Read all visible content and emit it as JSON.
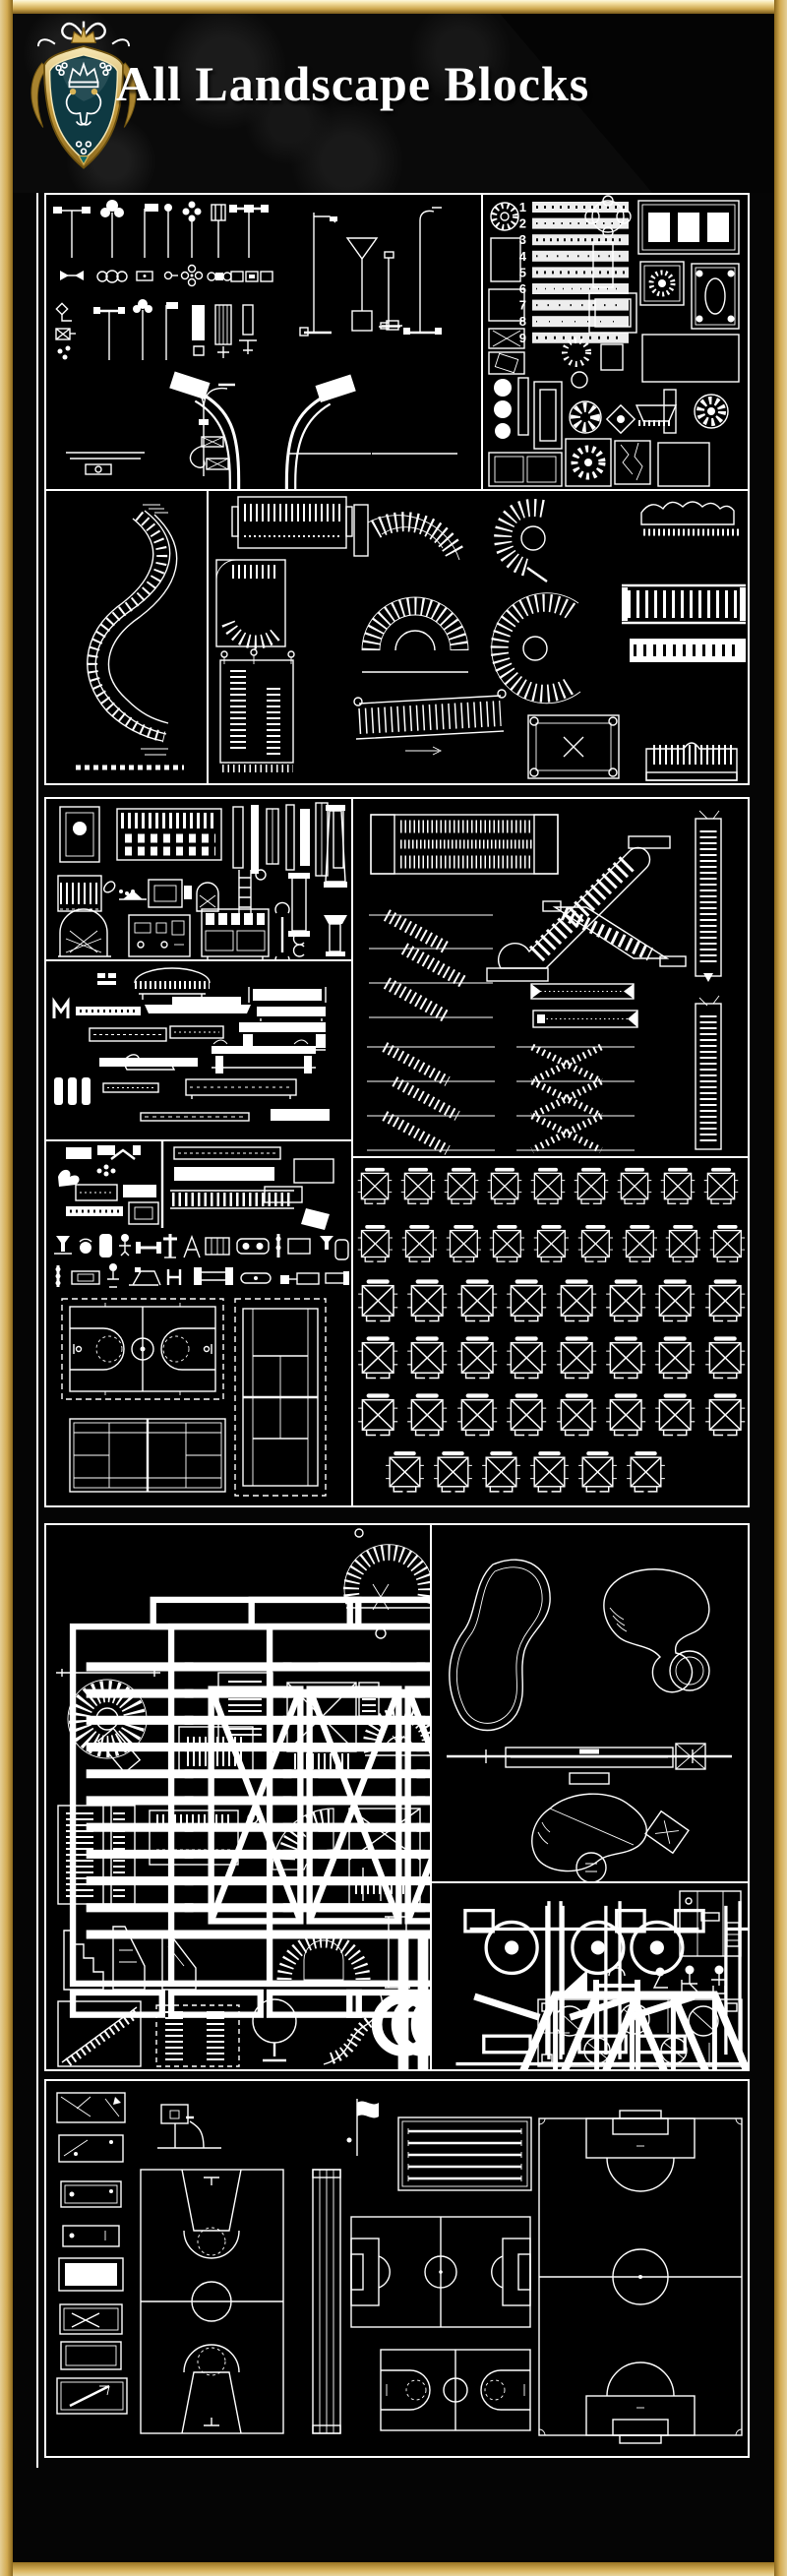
{
  "header": {
    "title": "All Landscape Blocks"
  },
  "frame": {
    "gold_light": "#f9efc8",
    "gold_mid": "#d7b35c",
    "gold_dark": "#8a671c"
  },
  "crest": {
    "gold": "#d9b457",
    "shield_fill": "#0e3942"
  },
  "canvas": {
    "background": "#000000",
    "line": "#ffffff"
  },
  "paving_legend": {
    "items": [
      "1",
      "2",
      "3",
      "4",
      "5",
      "6",
      "7",
      "8",
      "9"
    ]
  },
  "tables_grid": {
    "rows": [
      9,
      9,
      8,
      8,
      8,
      6
    ]
  }
}
